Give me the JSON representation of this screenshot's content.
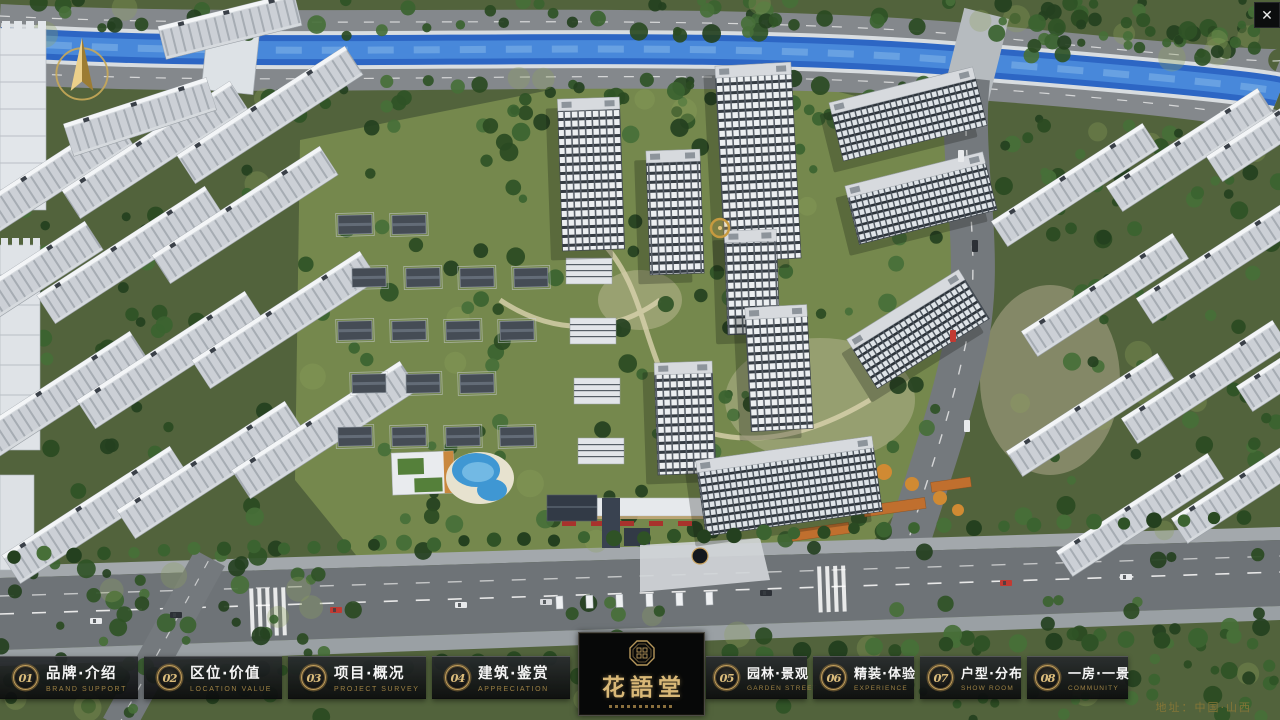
{
  "chrome": {
    "close_glyph": "✕"
  },
  "logo": {
    "title": "花語堂",
    "emblem": "octagon-seal"
  },
  "footer": {
    "address": "地址：中国·山西"
  },
  "nav": {
    "items": [
      {
        "num": "01",
        "cn": "品牌·介绍",
        "en": "BRAND SUPPORT"
      },
      {
        "num": "02",
        "cn": "区位·价值",
        "en": "LOCATION VALUE"
      },
      {
        "num": "03",
        "cn": "项目·概况",
        "en": "PROJECT SURVEY"
      },
      {
        "num": "04",
        "cn": "建筑·鉴赏",
        "en": "APPRECIATION"
      },
      {
        "num": "05",
        "cn": "园林·景观",
        "en": "GARDEN STREET"
      },
      {
        "num": "06",
        "cn": "精装·体验",
        "en": "EXPERIENCE"
      },
      {
        "num": "07",
        "cn": "户型·分布",
        "en": "SHOW ROOM"
      },
      {
        "num": "08",
        "cn": "一房·一景",
        "en": "COMMUNITY"
      }
    ]
  },
  "colors": {
    "gold_accent": "#c5a05c",
    "panel_dark": "#15171a",
    "river_blue": "#2d66c4",
    "grass_green": "#75884d",
    "awning_red": "#a8322c"
  }
}
